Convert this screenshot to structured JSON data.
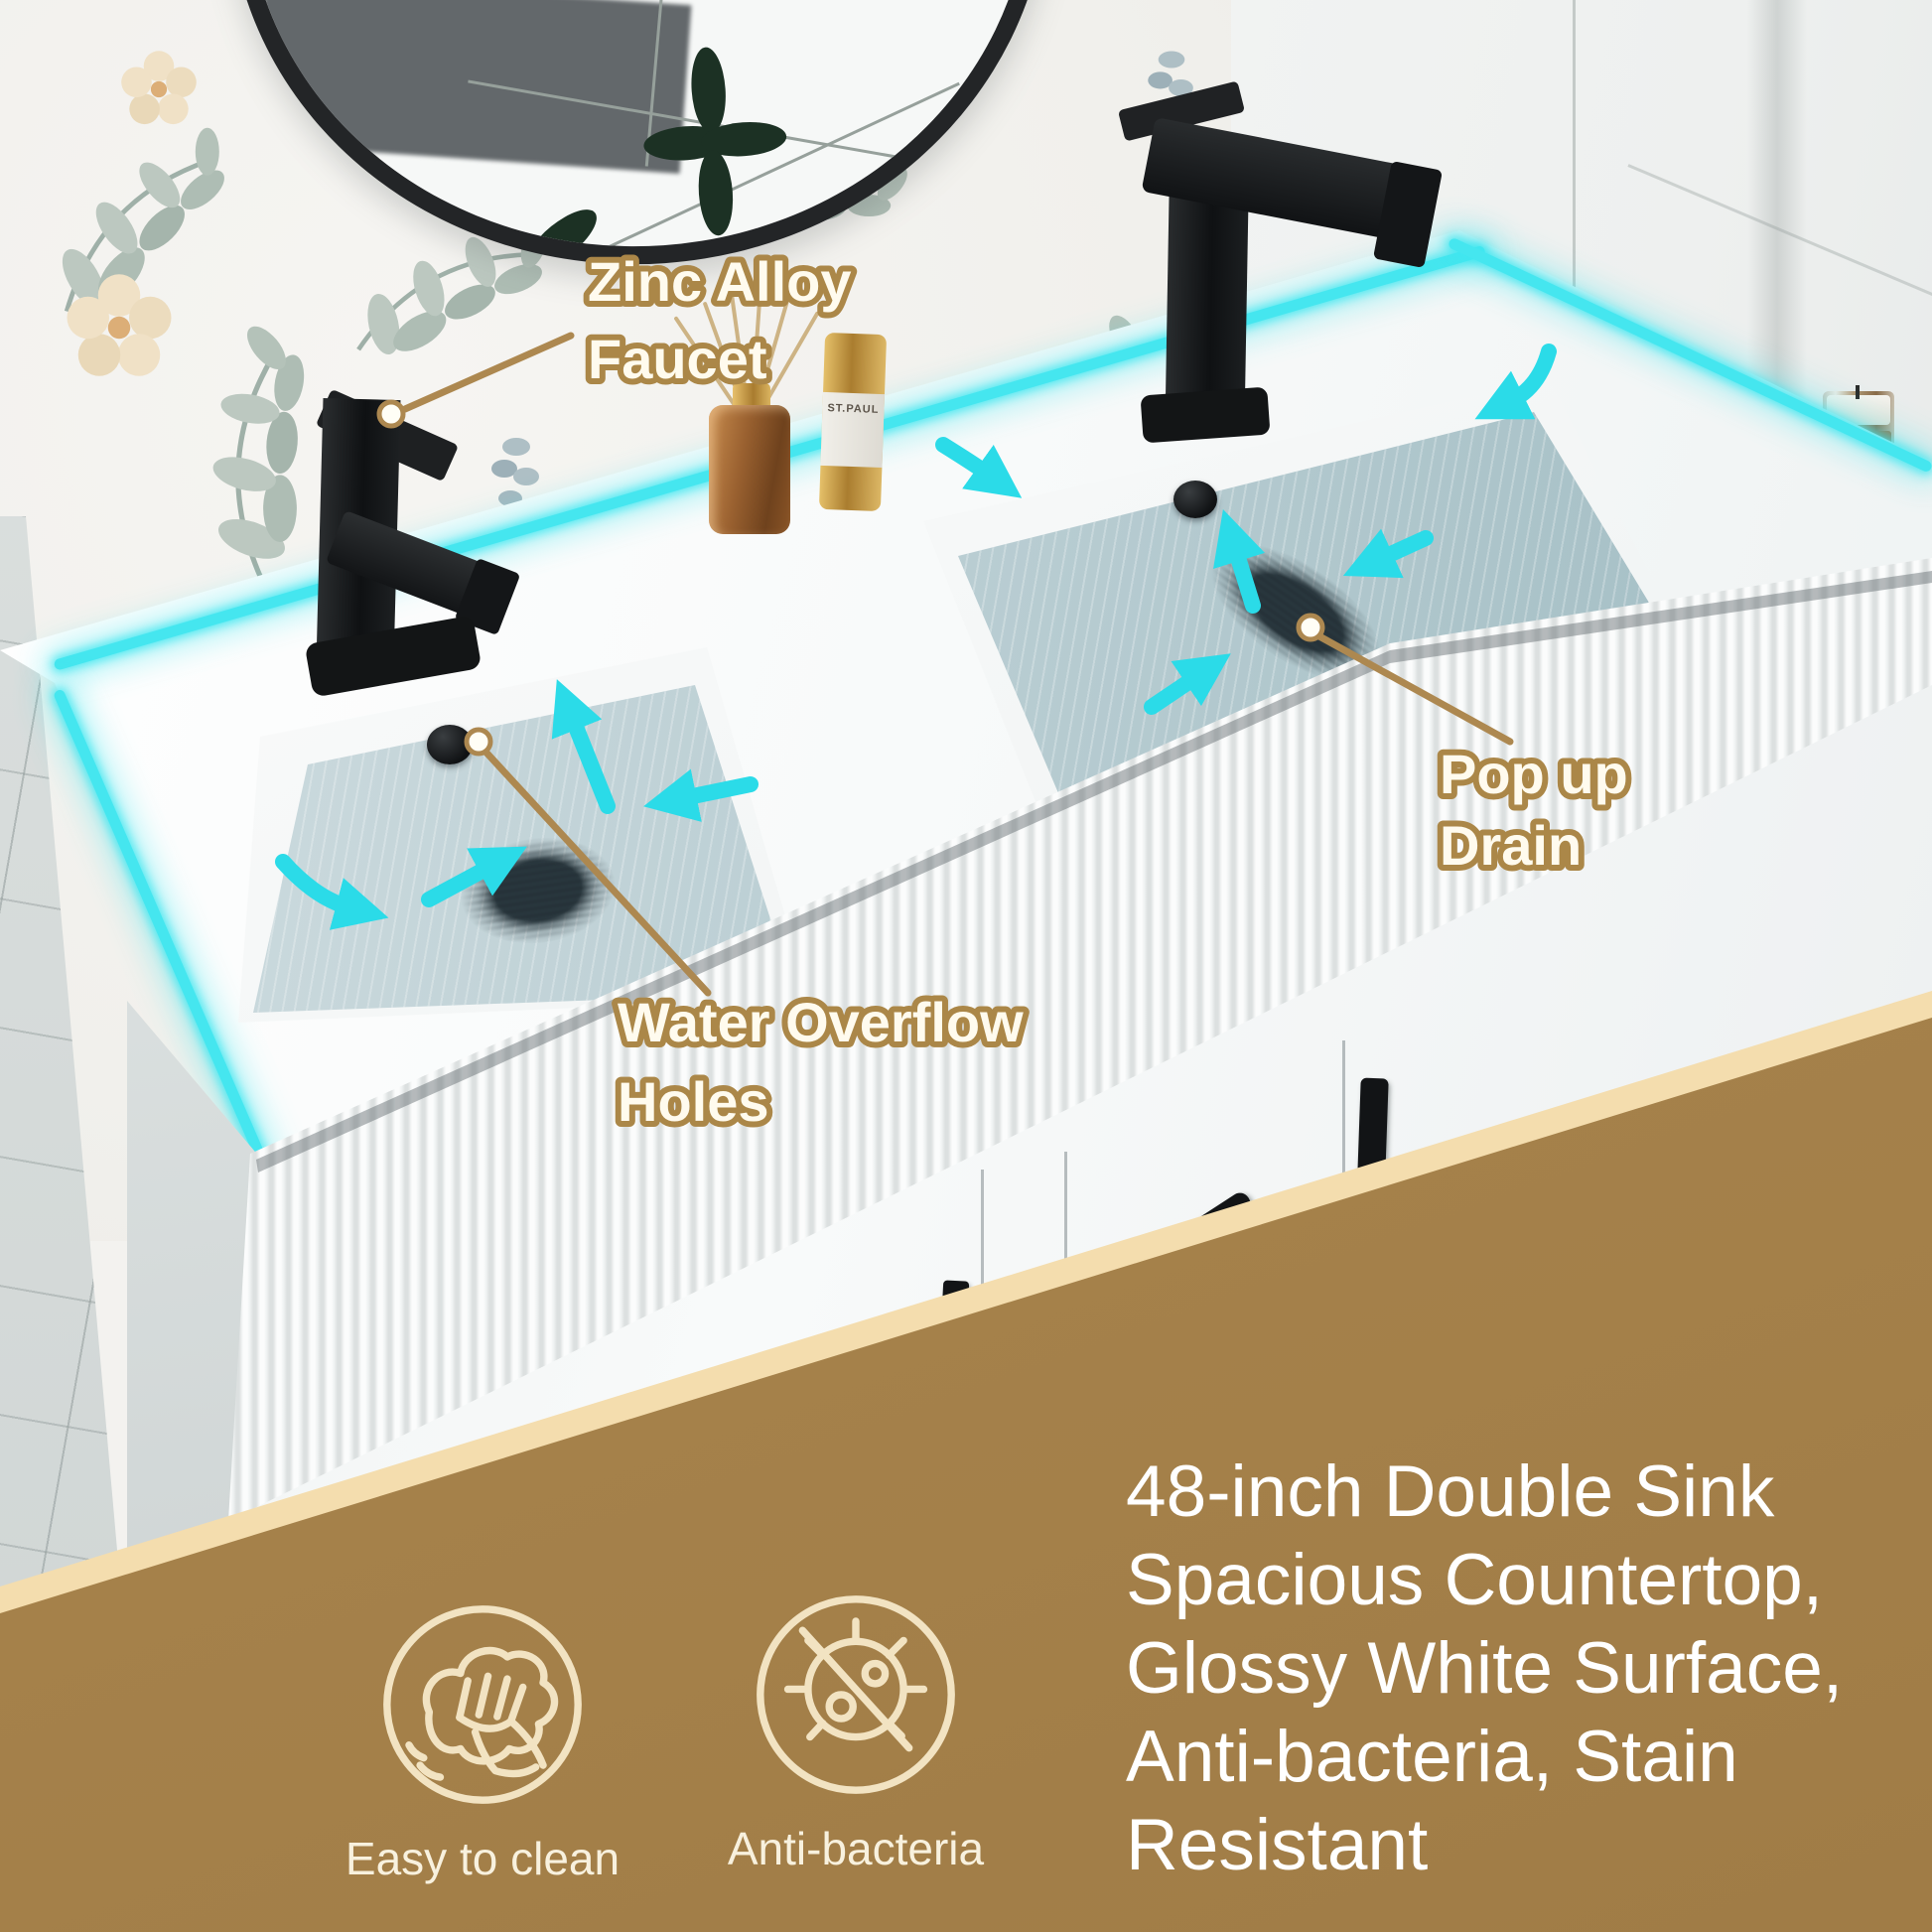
{
  "callouts": {
    "faucet": {
      "line1": "Zinc Alloy",
      "line2": "Faucet"
    },
    "overflow": {
      "line1": "Water Overflow",
      "line2": "Holes"
    },
    "drain": {
      "line1": "Pop up",
      "line2": "Drain"
    }
  },
  "features": [
    {
      "icon": "hand-wipe-icon",
      "label": "Easy to clean"
    },
    {
      "icon": "no-bacteria-icon",
      "label": "Anti-bacteria"
    }
  ],
  "description": "48-inch Double Sink\nSpacious Countertop,\nGlossy White Surface,\nAnti-bacteria, Stain\nResistant",
  "decor": {
    "bottle_label": "ST.PAUL"
  },
  "colors": {
    "panel_brown": "#a6824b",
    "band_cream": "#f4ddae",
    "accent_gold": "#ab8748",
    "led_cyan": "#45e6ef",
    "arrow_cyan": "#2bdbe8",
    "text_white": "#ffffff"
  }
}
